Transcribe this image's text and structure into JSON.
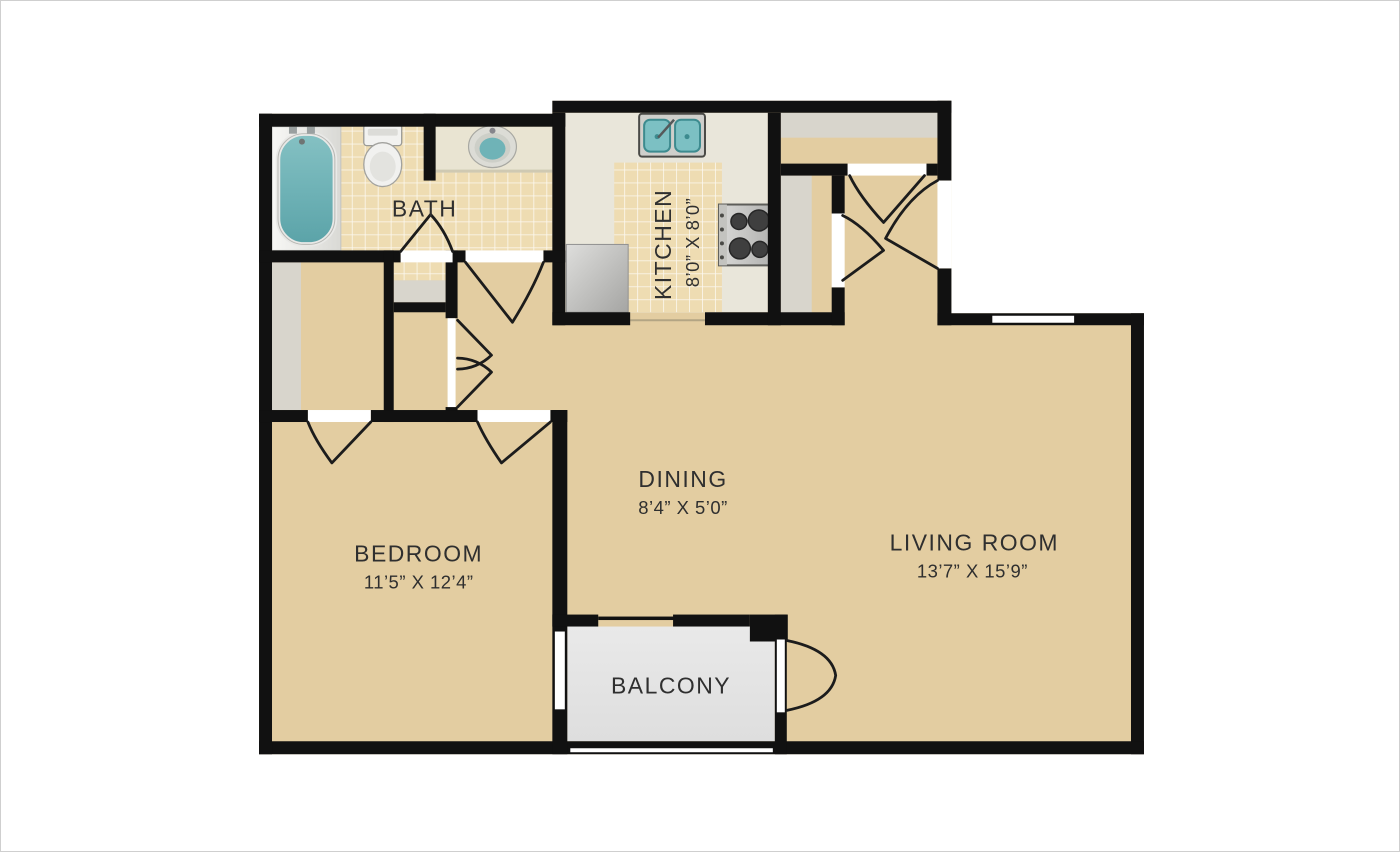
{
  "rooms": {
    "bath": {
      "label": "BATH"
    },
    "kitchen": {
      "label": "KITCHEN",
      "dimensions": "8’0” X 8’0”"
    },
    "dining": {
      "label": "DINING",
      "dimensions": "8’4” X 5’0”"
    },
    "living_room": {
      "label": "LIVING ROOM",
      "dimensions": "13’7” X 15’9”"
    },
    "bedroom": {
      "label": "BEDROOM",
      "dimensions": "11’5” X 12’4”"
    },
    "balcony": {
      "label": "BALCONY"
    }
  },
  "fixtures": [
    "bathtub",
    "toilet",
    "vanity-sink",
    "double-kitchen-sink",
    "stove-cooktop",
    "refrigerator"
  ],
  "colors": {
    "wall": "#111111",
    "floor_main": "#e3cda1",
    "floor_tile": "#eedcb2",
    "kitchen_counter": "#e9e6da",
    "balcony_floor": "#e4e4e4",
    "closet_shelf": "#d8d5cc",
    "fixture_teal": "#6fb3b7",
    "background": "#ffffff"
  }
}
